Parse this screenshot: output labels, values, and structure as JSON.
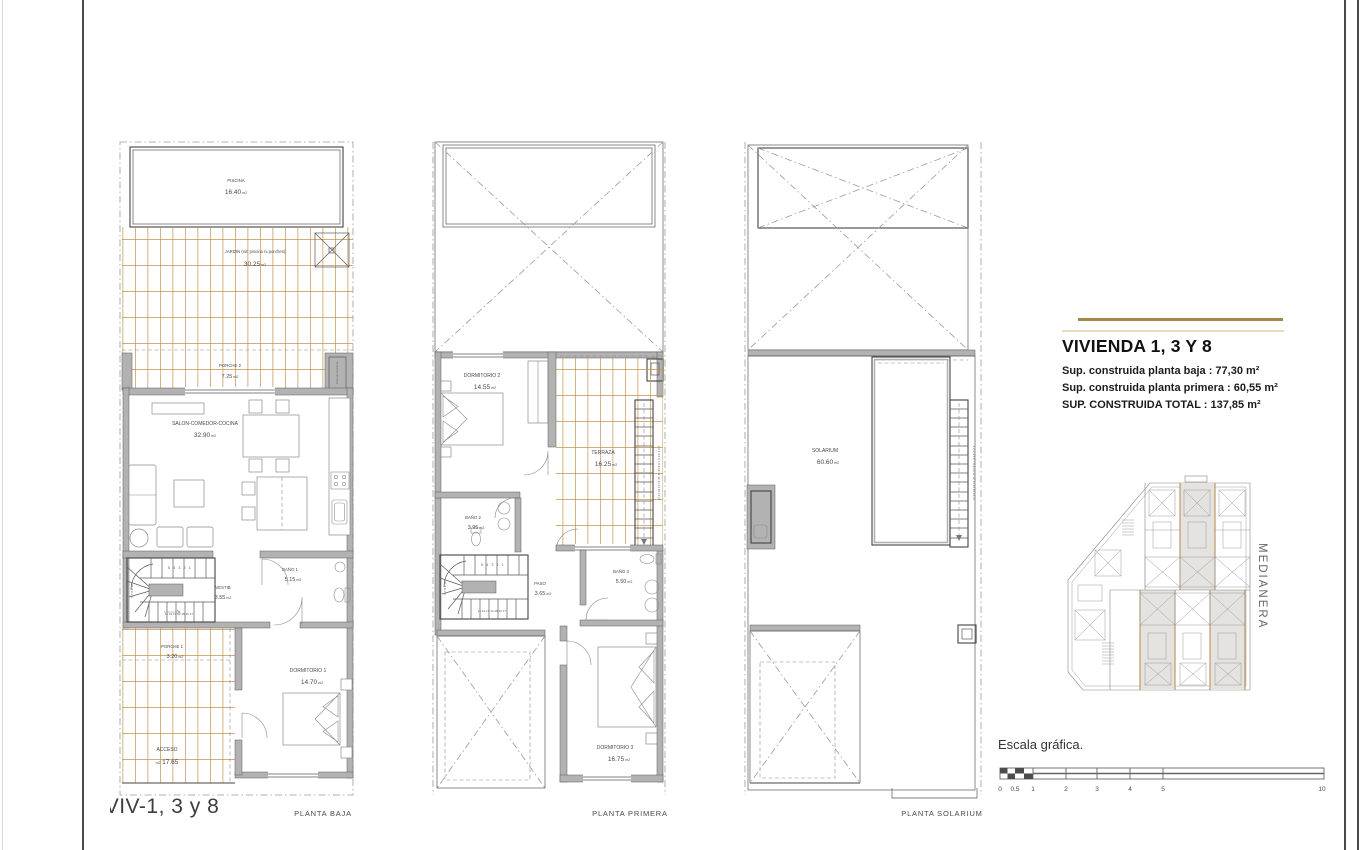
{
  "title_block": {
    "title": "VIVIENDA 1, 3 Y 8",
    "sup_baja": "Sup. construida planta baja : 77,30 m²",
    "sup_primera": "Sup. construida planta primera : 60,55 m²",
    "sup_total": "SUP. CONSTRUIDA TOTAL : 137,85 m²"
  },
  "legend": {
    "m2": "m2"
  },
  "sheet": {
    "unit_label": "VIV-1, 3 y 8"
  },
  "plan_baja": {
    "caption": "PLANTA BAJA",
    "rooms": {
      "piscina": {
        "name": "PISCINA",
        "area": "16.40"
      },
      "jardin": {
        "name": "JARDIN (sin piscina ni porches)",
        "area": "30.25"
      },
      "porche2": {
        "name": "PORCHE 2",
        "area": "7.25"
      },
      "armario": "Armario lavadora",
      "salon": {
        "name": "SALON-COMEDOR-COCINA",
        "area": "32.90"
      },
      "vestib": {
        "name": "VESTIB",
        "area": "3.55"
      },
      "bano1": {
        "name": "BAÑO 1",
        "area": "5.15"
      },
      "porche1": {
        "name": "PORCHE 1",
        "area": "3.20"
      },
      "acceso": {
        "name": "ACCESO",
        "area": "17.65"
      },
      "dormitorio1": {
        "name": "DORMITORIO 1",
        "area": "14.70"
      }
    }
  },
  "plan_primera": {
    "caption": "PLANTA PRIMERA",
    "rooms": {
      "dormitorio2": {
        "name": "DORMITORIO 2",
        "area": "14.55"
      },
      "terraza": {
        "name": "TERRAZA",
        "area": "16.25"
      },
      "bano2": {
        "name": "BAÑO 2",
        "area": "3.95"
      },
      "paso": {
        "name": "PASO",
        "area": "3.65"
      },
      "bano3": {
        "name": "BAÑO 3",
        "area": "5.50"
      },
      "dormitorio3": {
        "name": "DORMITORIO 3",
        "area": "16.75"
      }
    }
  },
  "plan_solarium": {
    "caption": "PLANTA SOLARIUM",
    "rooms": {
      "solarium": {
        "name": "SOLARIUM",
        "area": "60.60"
      }
    }
  },
  "stairs": {
    "top_run": "5 4 3 2 1",
    "side_run": "6 7 8 9 10",
    "bottom_run": "11 12 13 14 15 16 17",
    "straight_run": "1 2 3 4 5 6 7 8 9 10 11 12 13 14 15 16 17"
  },
  "key_plan": {
    "medianera": "MEDIANERA"
  },
  "scale_bar": {
    "label": "Escala gráfica.",
    "ticks": [
      "0",
      "0.5",
      "1",
      "2",
      "3",
      "4",
      "5",
      "10"
    ]
  },
  "colors": {
    "hatch": "#c0934e",
    "wall": "#b2b2b2",
    "accent_dark": "#a3874a",
    "accent_light": "#e7dcbd",
    "hl_fill": "#e4e3e0",
    "hl_stroke": "#b5854a"
  }
}
